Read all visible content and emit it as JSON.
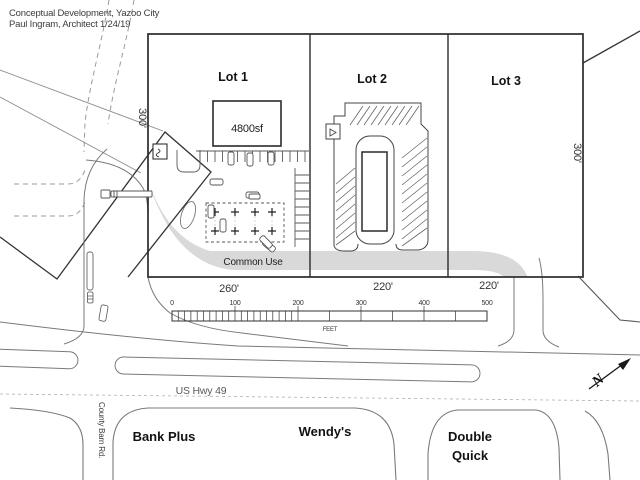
{
  "title": {
    "line1": "Conceptual Development, Yazoo City",
    "line2": "Paul Ingram, Architect  1/24/19"
  },
  "lots": [
    {
      "label": "Lot 1"
    },
    {
      "label": "Lot 2"
    },
    {
      "label": "Lot 3"
    }
  ],
  "building": {
    "area_label": "4800sf"
  },
  "common_use": {
    "label": "Common Use"
  },
  "dimensions": {
    "left_depth": "300'",
    "right_depth": "300'",
    "lot1_width": "260'",
    "lot2_width": "220'",
    "lot3_width": "220'"
  },
  "scale_bar": {
    "ticks": [
      "0",
      "100",
      "200",
      "300",
      "400",
      "500"
    ],
    "unit": "FEET"
  },
  "roads": {
    "highway": "US Hwy 49",
    "side_road": "County Barn Rd."
  },
  "businesses": [
    {
      "name": "Bank Plus"
    },
    {
      "name": "Wendy's"
    },
    {
      "name": "Double Quick",
      "line1": "Double",
      "line2": "Quick"
    }
  ],
  "north_arrow": {
    "letter": "N"
  },
  "colors": {
    "parcel_line": "#2b2b2b",
    "road_line": "#7a7a7a",
    "common_use_fill": "#d9d9d9",
    "background": "#ffffff"
  }
}
